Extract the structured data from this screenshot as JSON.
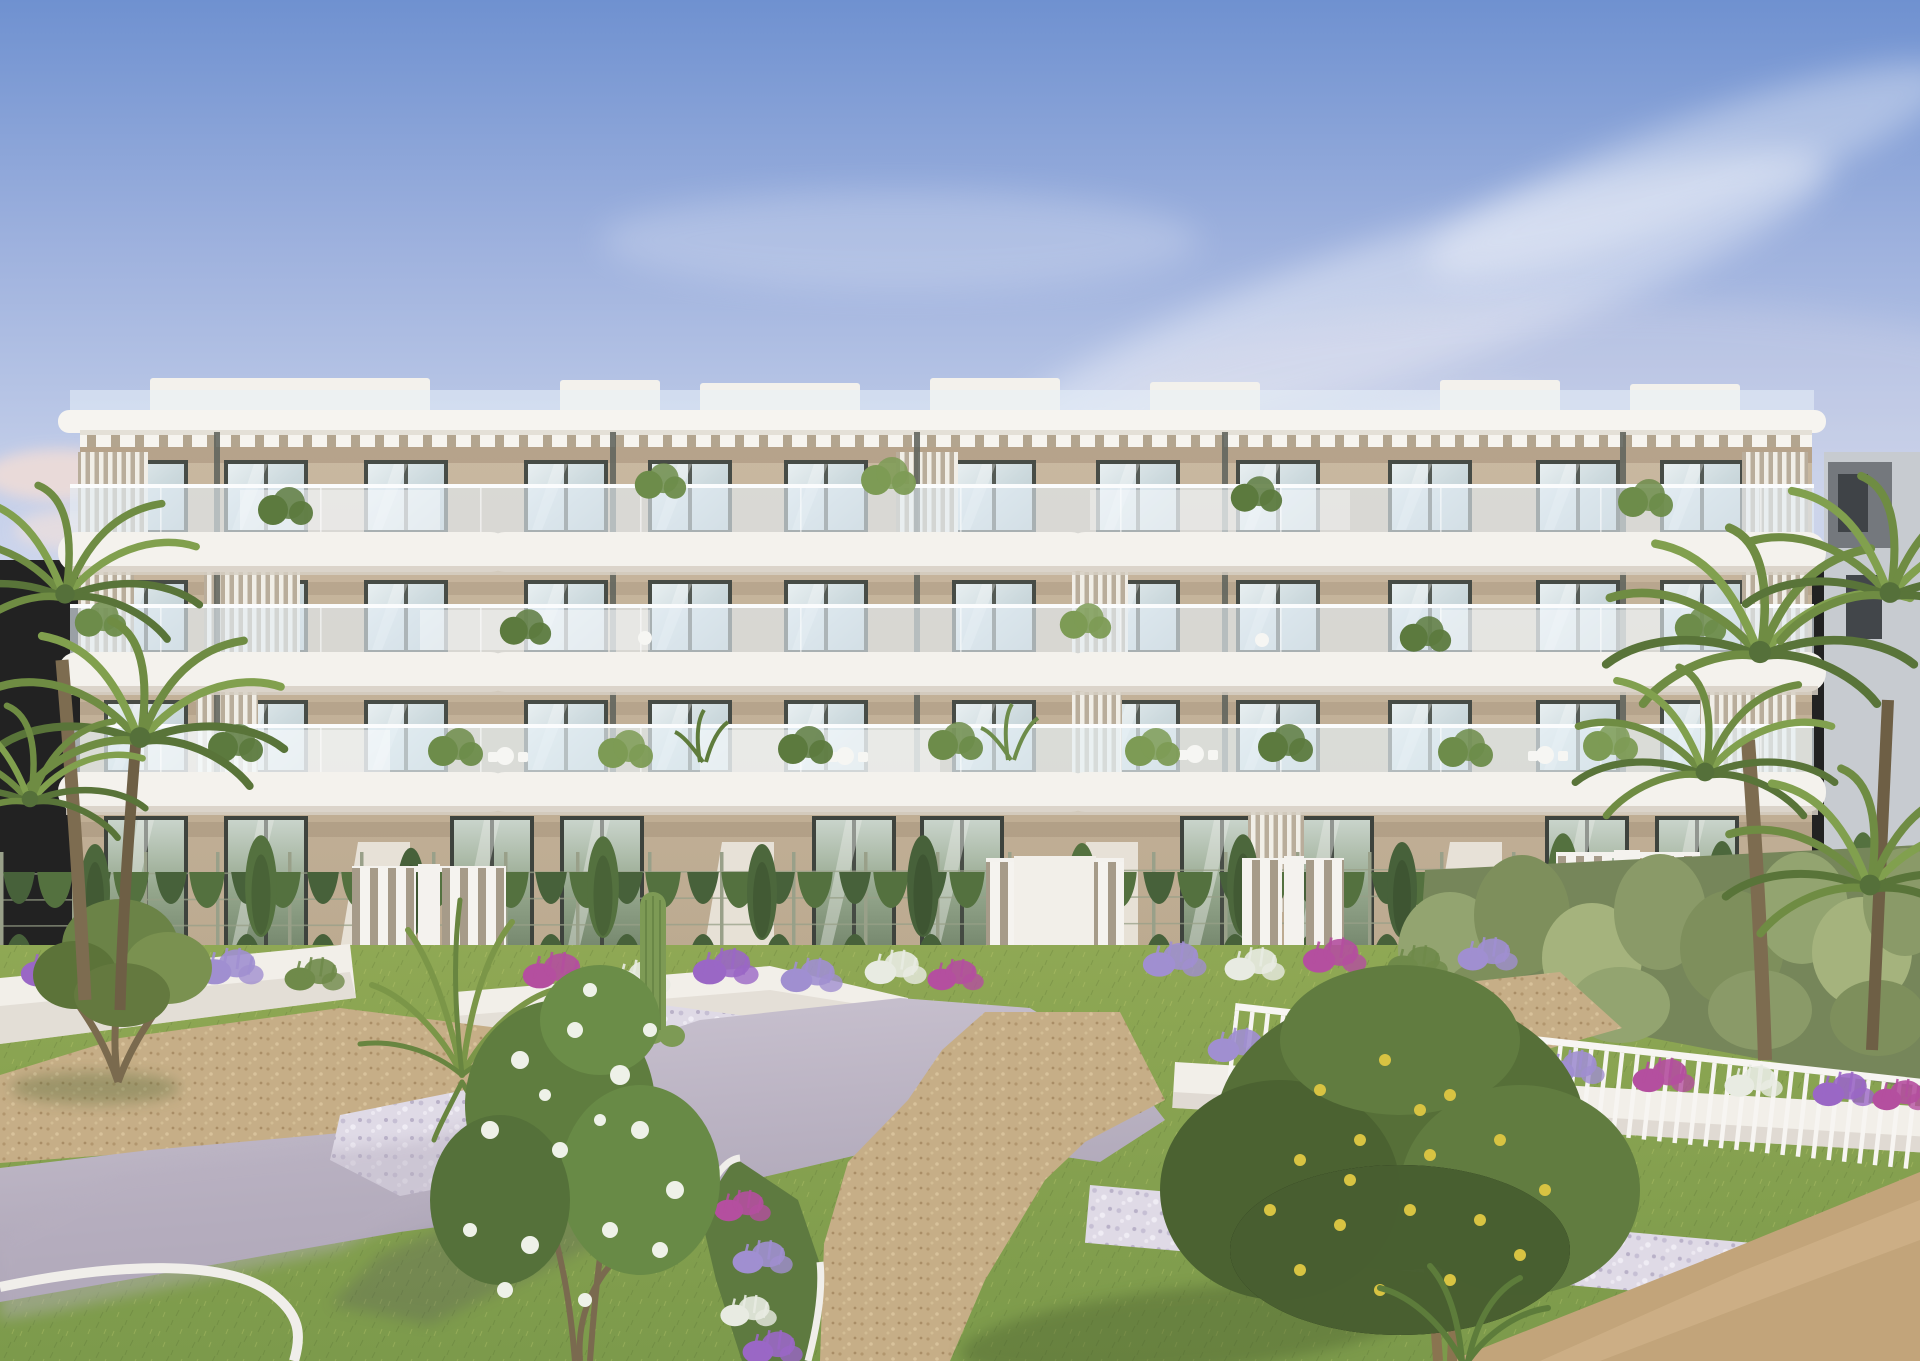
{
  "meta": {
    "kind": "architectural-render",
    "description": "Sunset 3D render of a modern four-storey white apartment building with curved balconies, glass railings, rooftop pergolas, landscaped terraced gardens with lawns, paths, flower beds, cacti and palm trees",
    "width": 1920,
    "height": 1361
  },
  "scene": {
    "sky": {
      "top": "#6f91d0",
      "mid": "#9fb2de",
      "horizon": "#ccd5ec",
      "cloud_white": "#f6f3f4",
      "cloud_pink": "#eedcd8"
    },
    "background": {
      "gray_building": "#c7cbd0",
      "gray_building_dark": "#74787d",
      "gray_window": "#3f4347"
    },
    "building": {
      "floors": 4,
      "windows_per_floor": 12,
      "fascia": "#f4f2ed",
      "fascia_shadow": "#d6cfc3",
      "wall": "#c6b59d",
      "wall_shade": "#a5927a",
      "window_frame": "#474c46",
      "pergola_gap": "#b3a58f",
      "post": "#63665e",
      "louvre_gap": "#b9ad9b",
      "roof_white": "#f6f4f0",
      "railing_glass": "rgba(228,238,245,0.62)"
    },
    "garden": {
      "lawn": "#85a251",
      "lawn_light": "#93ad5b",
      "lawn_shade": "#66853f",
      "hedge": "#52703f",
      "hedge_dark": "#465f37",
      "bush_olive": "#94a471",
      "concrete_path": "#c9c2cf",
      "concrete_shade": "#a59db0",
      "gravel": "#c6ae87",
      "pebble": "#dfdae6",
      "sand": "#c2a47a",
      "planter_white": "#f2efe9",
      "planter_shade": "#d8d2c9",
      "curb_white": "#f0eeea"
    },
    "flora": {
      "palm": "#7d9a49",
      "palm_dark": "#5f7c3c",
      "tree_green": "#617c40",
      "tree_dark": "#4b6432",
      "lemon_fruit": "#d8c342",
      "blossom_white": "#eef1e8",
      "lavender": "#a08fd0",
      "magenta": "#b44f9f",
      "purple": "#9a67c5",
      "trunk": "#84714f",
      "cactus": "#7d9a55"
    },
    "fence": {
      "railing_white": "#f6f4f1",
      "wire": "#98a088",
      "gate_white": "#f4f2ee"
    }
  }
}
